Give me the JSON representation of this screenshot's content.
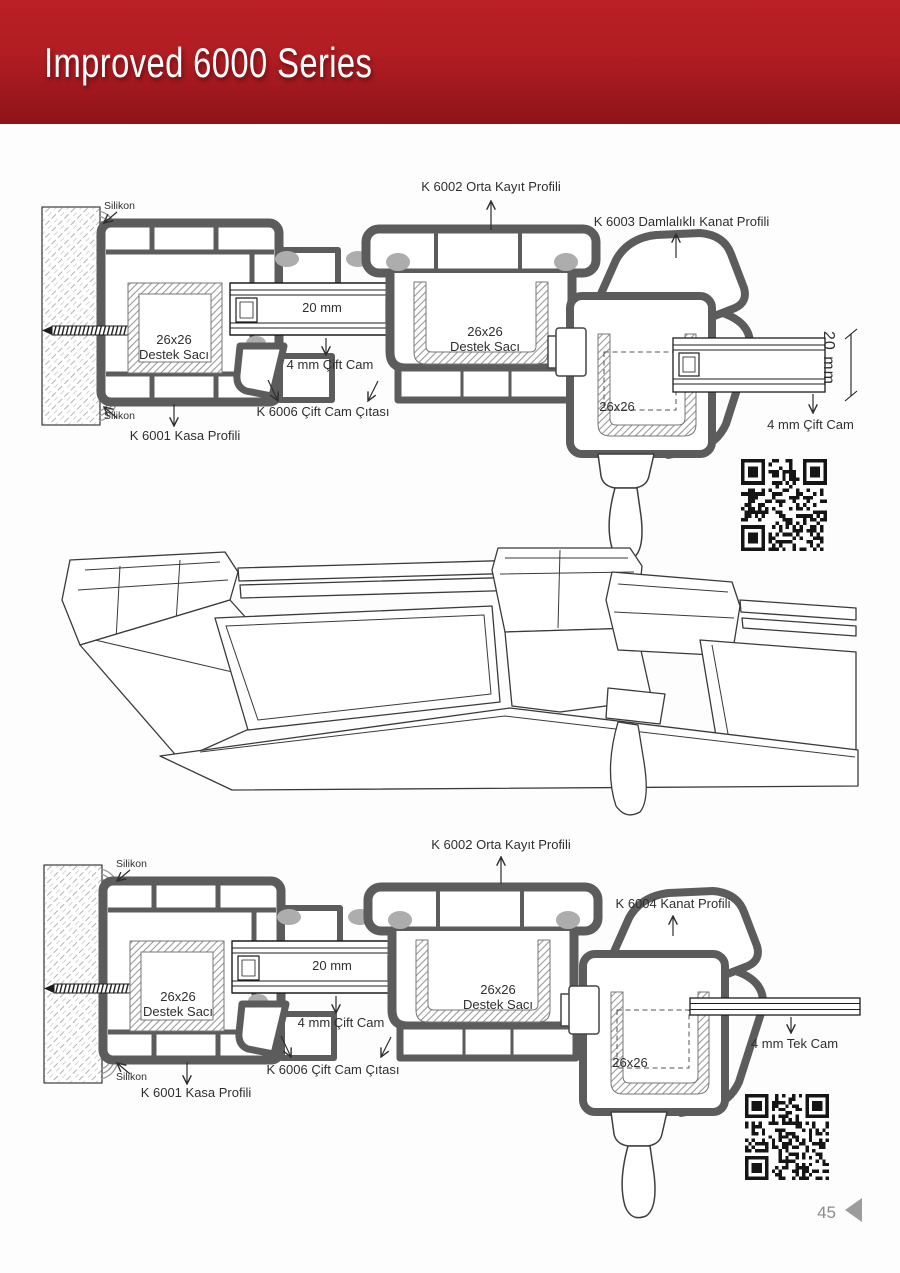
{
  "header": {
    "title": "Improved 6000 Series",
    "banner_color": "#b01d22"
  },
  "footer": {
    "page_number": "45"
  },
  "top_diagram": {
    "labels": {
      "orta_kayit": "K 6002 Orta Kayıt Profili",
      "damlalikli_kanat": "K 6003 Damlalıklı Kanat Profili",
      "silikon_top": "Silikon",
      "silikon_bottom": "Silikon",
      "destek_saci_frame": "26x26\nDestek Sacı",
      "destek_saci_mullion": "26x26\nDestek Sacı",
      "glass_unit_width": "20 mm",
      "cift_cam_middle": "4 mm Çift Cam",
      "cift_cam_citasi": "K 6006 Çift Cam Çıtası",
      "kasa_profili": "K 6001 Kasa Profili",
      "destek_saci_sash": "26x26",
      "glass_thickness": "20 mm",
      "cift_cam_right": "4 mm Çift Cam"
    }
  },
  "bottom_diagram": {
    "labels": {
      "orta_kayit": "K 6002 Orta Kayıt Profili",
      "kanat_profili": "K 6004 Kanat Profili",
      "silikon_top": "Silikon",
      "silikon_bottom": "Silikon",
      "destek_saci_frame": "26x26\nDestek Sacı",
      "destek_saci_mullion": "26x26\nDestek Sacı",
      "glass_unit_width": "20 mm",
      "cift_cam_middle": "4 mm Çift Cam",
      "cift_cam_citasi": "K 6006 Çift Cam Çıtası",
      "kasa_profili": "K 6001 Kasa Profili",
      "destek_saci_sash": "26x26",
      "tek_cam": "4 mm Tek Cam"
    }
  }
}
